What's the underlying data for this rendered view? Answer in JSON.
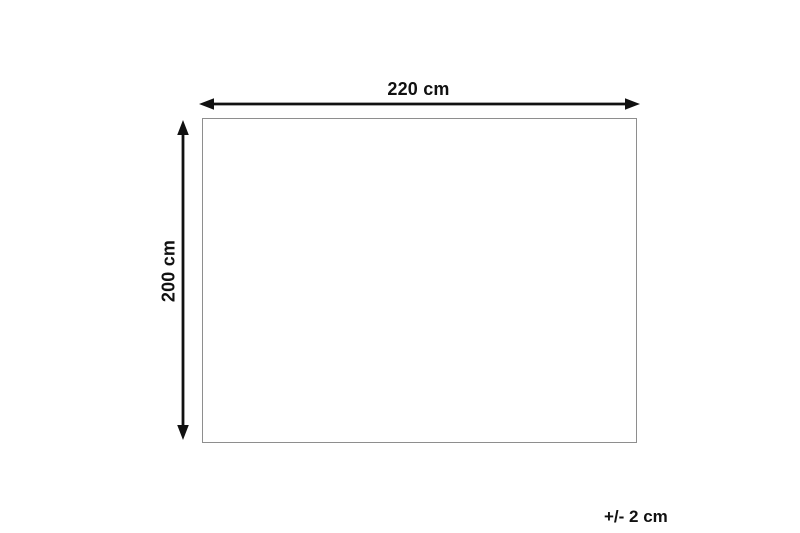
{
  "diagram": {
    "type": "product-dimension-diagram",
    "width_label": "220 cm",
    "height_label": "200 cm",
    "tolerance_label": "+/- 2 cm",
    "dimensions": {
      "width_cm": 220,
      "height_cm": 200,
      "tolerance_cm": 2
    },
    "colors": {
      "background": "#ffffff",
      "arrow": "#111111",
      "text": "#111111",
      "outline_border": "#8e8e8e",
      "outline_fill": "#ffffff"
    },
    "icons": {
      "horizontal_arrow": "double-headed-horizontal-arrow",
      "vertical_arrow": "double-headed-vertical-arrow"
    }
  }
}
